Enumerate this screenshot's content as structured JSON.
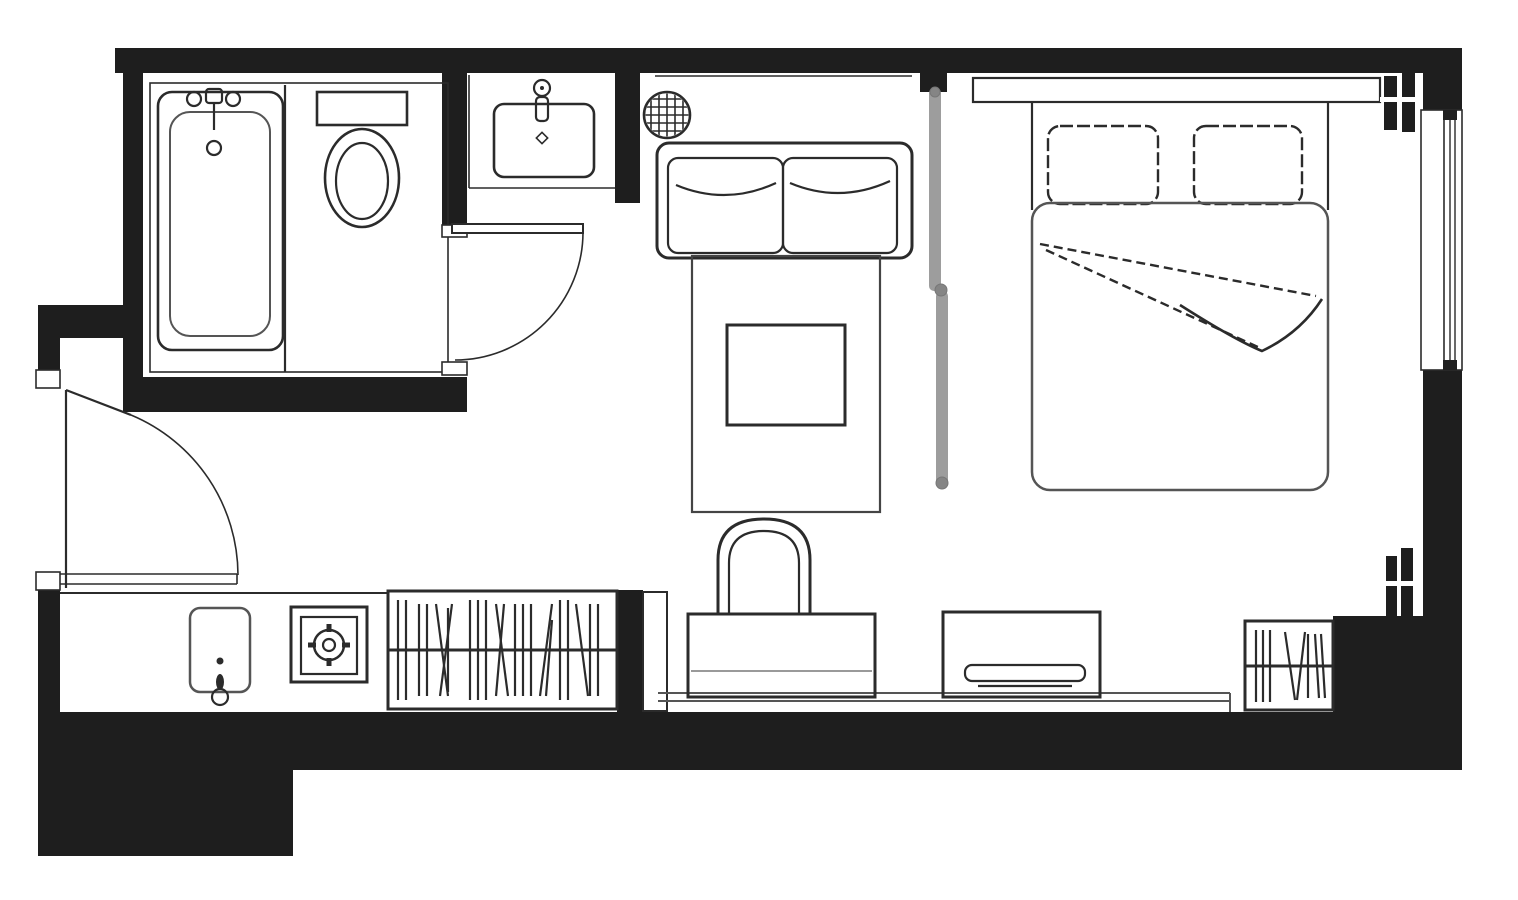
{
  "plan": {
    "type": "floor-plan",
    "title": "Studio hotel room floor plan",
    "aria_label": "Black and white architectural floor plan of a studio room with bathroom, kitchenette, living area and bedroom"
  },
  "colors": {
    "bg": "#ffffff",
    "wall": "#1e1e1e",
    "ink": "#2b2b2b",
    "soft": "#555555",
    "faint": "#8c8c8c",
    "slider": "#9d9d9d",
    "knob": "#858585"
  },
  "rooms": [
    {
      "name": "bathroom"
    },
    {
      "name": "toilet-area"
    },
    {
      "name": "basin-alcove"
    },
    {
      "name": "entry-hall"
    },
    {
      "name": "kitchenette"
    },
    {
      "name": "living-area"
    },
    {
      "name": "bedroom"
    }
  ],
  "fixtures": [
    {
      "name": "bathtub-icon",
      "room": "bathroom"
    },
    {
      "name": "toilet-icon",
      "room": "toilet-area"
    },
    {
      "name": "washbasin-icon",
      "room": "basin-alcove"
    },
    {
      "name": "extractor-fan-icon",
      "room": "living-area"
    },
    {
      "name": "entry-door-swing-icon",
      "room": "entry-hall"
    },
    {
      "name": "bathroom-door-swing-icon",
      "room": "bathroom"
    },
    {
      "name": "kitchen-sink-icon",
      "room": "kitchenette"
    },
    {
      "name": "stove-burner-icon",
      "room": "kitchenette"
    },
    {
      "name": "wardrobe-hanging-rail-icon",
      "room": "kitchenette"
    },
    {
      "name": "sofa-icon",
      "room": "living-area"
    },
    {
      "name": "rug-icon",
      "room": "living-area"
    },
    {
      "name": "coffee-table-icon",
      "room": "living-area"
    },
    {
      "name": "tub-chair-icon",
      "room": "living-area"
    },
    {
      "name": "desk-icon",
      "room": "living-area"
    },
    {
      "name": "sliding-door-icon",
      "room": "bedroom"
    },
    {
      "name": "double-bed-icon",
      "room": "bedroom"
    },
    {
      "name": "pillow-icon",
      "room": "bedroom"
    },
    {
      "name": "tv-console-icon",
      "room": "bedroom"
    },
    {
      "name": "flat-tv-icon",
      "room": "bedroom"
    },
    {
      "name": "closet-hanging-rail-icon",
      "room": "bedroom"
    },
    {
      "name": "window-icon",
      "room": "bedroom"
    },
    {
      "name": "wall-break-icon",
      "room": "bedroom"
    }
  ]
}
